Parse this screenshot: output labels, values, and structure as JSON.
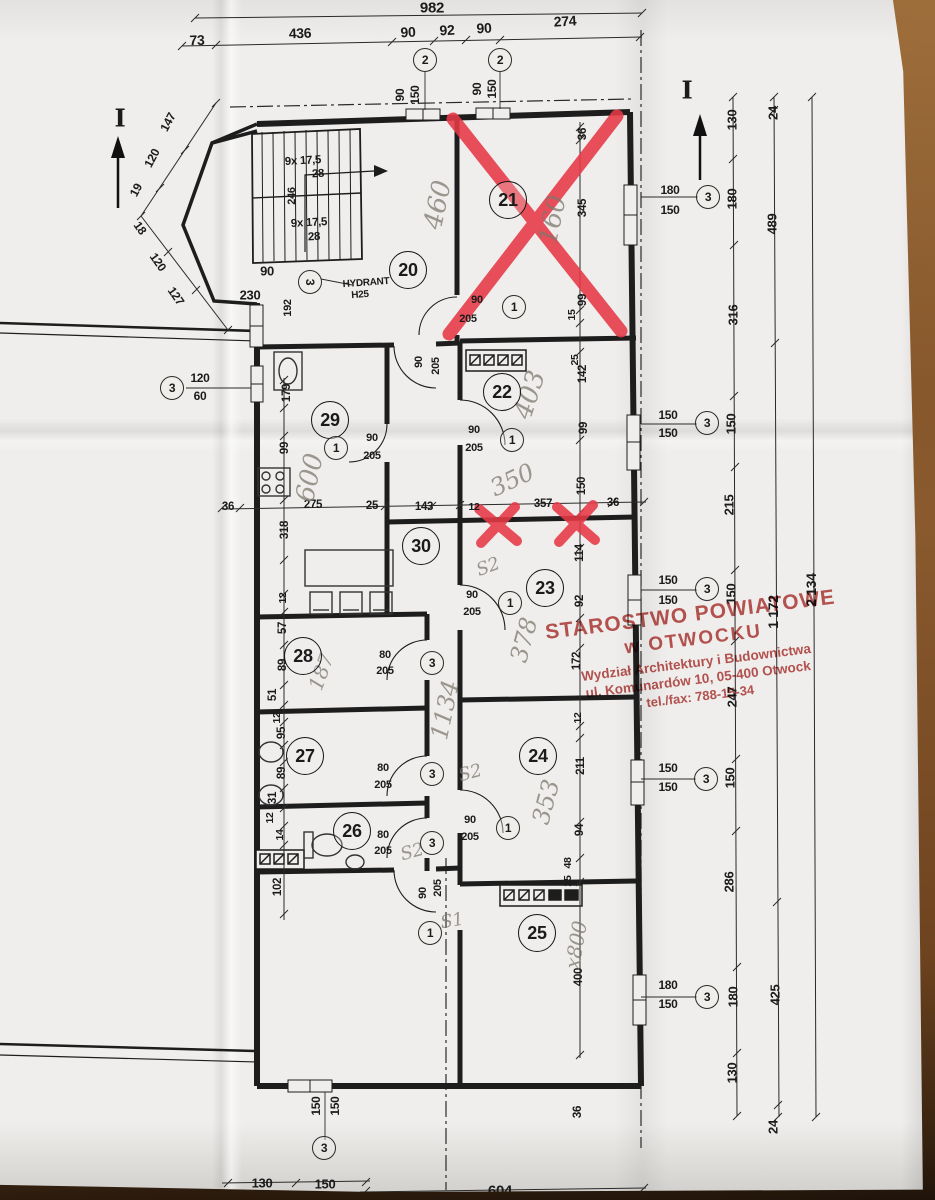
{
  "stamp": {
    "line1": "STAROSTWO POWIATOWE",
    "line2": "w OTWOCKU",
    "line3": "Wydział Architektury i Budownictwa",
    "line4": "ul. Komunardów 10, 05-400 Otwock",
    "line5": "tel./fax: 788-15-34"
  },
  "rooms": [
    [
      "20",
      408,
      270
    ],
    [
      "21",
      508,
      200
    ],
    [
      "22",
      502,
      392
    ],
    [
      "23",
      545,
      588
    ],
    [
      "24",
      538,
      756
    ],
    [
      "25",
      537,
      933
    ],
    [
      "26",
      352,
      831
    ],
    [
      "27",
      305,
      756
    ],
    [
      "28",
      303,
      656
    ],
    [
      "29",
      330,
      420
    ],
    [
      "30",
      421,
      546
    ]
  ],
  "bubbles": [
    [
      "2",
      425,
      60
    ],
    [
      "2",
      500,
      60
    ],
    [
      "3",
      708,
      197
    ],
    [
      "3",
      707,
      423
    ],
    [
      "3",
      707,
      589
    ],
    [
      "3",
      706,
      779
    ],
    [
      "3",
      707,
      997
    ],
    [
      "3",
      172,
      388
    ],
    [
      "3",
      324,
      1148
    ],
    [
      "1",
      514,
      307
    ],
    [
      "1",
      512,
      440
    ],
    [
      "1",
      336,
      448
    ],
    [
      "1",
      510,
      603
    ],
    [
      "1",
      508,
      828
    ],
    [
      "1",
      430,
      933
    ],
    [
      "3",
      432,
      663
    ],
    [
      "3",
      432,
      774
    ],
    [
      "3",
      432,
      843
    ],
    [
      "3",
      310,
      282,
      90
    ]
  ],
  "sections": [
    [
      "I",
      120,
      118
    ],
    [
      "I",
      687,
      90
    ]
  ],
  "dims": [
    [
      "982",
      432,
      8,
      0,
      15
    ],
    [
      "73",
      197,
      40,
      -2,
      14
    ],
    [
      "436",
      300,
      33,
      -2,
      14
    ],
    [
      "90",
      408,
      32,
      -3,
      14
    ],
    [
      "92",
      447,
      30,
      -3,
      14
    ],
    [
      "90",
      484,
      28,
      -3,
      14
    ],
    [
      "274",
      565,
      21,
      -3,
      14
    ],
    [
      "90",
      400,
      95,
      -90,
      12
    ],
    [
      "150",
      415,
      95,
      -90,
      12
    ],
    [
      "90",
      477,
      89,
      -90,
      12
    ],
    [
      "150",
      492,
      89,
      -90,
      12
    ],
    [
      "147",
      168,
      122,
      -62,
      12
    ],
    [
      "120",
      152,
      158,
      -62,
      12
    ],
    [
      "19",
      136,
      190,
      -62,
      12
    ],
    [
      "18",
      140,
      228,
      55,
      12
    ],
    [
      "120",
      158,
      262,
      55,
      12
    ],
    [
      "127",
      176,
      296,
      55,
      12
    ],
    [
      "9x 17,5",
      303,
      161,
      -3,
      11.5
    ],
    [
      "28",
      318,
      174,
      -3,
      11.5
    ],
    [
      "246",
      292,
      196,
      -90,
      11
    ],
    [
      "9x 17,5",
      309,
      223,
      -3,
      11.5
    ],
    [
      "28",
      314,
      237,
      -3,
      11.5
    ],
    [
      "90",
      267,
      271,
      0,
      13
    ],
    [
      "230",
      250,
      295,
      0,
      13
    ],
    [
      "192",
      288,
      308,
      -90,
      11
    ],
    [
      "90",
      477,
      300,
      0,
      11
    ],
    [
      "205",
      468,
      319,
      0,
      11
    ],
    [
      "90",
      419,
      362,
      -90,
      11
    ],
    [
      "205",
      436,
      366,
      -90,
      11
    ],
    [
      "36",
      583,
      134,
      -90,
      11.5
    ],
    [
      "345",
      583,
      208,
      -90,
      11.5
    ],
    [
      "99",
      583,
      300,
      -90,
      11.5
    ],
    [
      "15",
      572,
      315,
      -90,
      10.5
    ],
    [
      "25",
      575,
      360,
      -90,
      10.5
    ],
    [
      "142",
      583,
      374,
      -90,
      11.5
    ],
    [
      "99",
      584,
      428,
      -90,
      11.5
    ],
    [
      "150",
      582,
      486,
      -90,
      11.5
    ],
    [
      "114",
      580,
      553,
      -90,
      11.5
    ],
    [
      "92",
      580,
      601,
      -90,
      11.5
    ],
    [
      "172",
      577,
      661,
      -90,
      11.5
    ],
    [
      "12",
      578,
      718,
      -90,
      10.5
    ],
    [
      "211",
      581,
      766,
      -90,
      11.5
    ],
    [
      "94",
      580,
      830,
      -90,
      11.5
    ],
    [
      "48",
      568,
      863,
      -90,
      10.5
    ],
    [
      "25",
      568,
      881,
      -90,
      10.5
    ],
    [
      "400",
      579,
      977,
      -90,
      11.5
    ],
    [
      "36",
      578,
      1112,
      -90,
      11.5
    ],
    [
      "36",
      228,
      507,
      0,
      11.5
    ],
    [
      "275",
      313,
      505,
      0,
      11.5
    ],
    [
      "25",
      372,
      506,
      0,
      11.5
    ],
    [
      "143",
      424,
      507,
      0,
      11.5
    ],
    [
      "12",
      474,
      507,
      0,
      10.5
    ],
    [
      "357",
      543,
      504,
      0,
      11.5
    ],
    [
      "36",
      613,
      503,
      0,
      11.5
    ],
    [
      "179",
      287,
      393,
      -90,
      11.5
    ],
    [
      "99",
      285,
      448,
      -90,
      11.5
    ],
    [
      "318",
      285,
      530,
      -90,
      11.5
    ],
    [
      "12",
      283,
      598,
      -90,
      10.5
    ],
    [
      "57",
      283,
      628,
      -90,
      11.5
    ],
    [
      "89",
      283,
      665,
      -90,
      11.5
    ],
    [
      "51",
      273,
      695,
      -90,
      11.5
    ],
    [
      "12",
      277,
      718,
      -90,
      10.5
    ],
    [
      "95",
      282,
      733,
      -90,
      11.5
    ],
    [
      "89",
      282,
      773,
      -90,
      11.5
    ],
    [
      "31",
      273,
      798,
      -90,
      11.5
    ],
    [
      "12",
      270,
      818,
      -90,
      10.5
    ],
    [
      "14",
      280,
      835,
      -90,
      10.5
    ],
    [
      "102",
      278,
      887,
      -90,
      11.5
    ],
    [
      "120",
      200,
      378,
      0,
      12
    ],
    [
      "60",
      200,
      396,
      0,
      12
    ],
    [
      "90",
      474,
      430,
      0,
      11
    ],
    [
      "205",
      474,
      448,
      0,
      11
    ],
    [
      "90",
      372,
      438,
      0,
      11
    ],
    [
      "205",
      372,
      456,
      0,
      11
    ],
    [
      "90",
      472,
      595,
      0,
      11
    ],
    [
      "205",
      472,
      612,
      0,
      11
    ],
    [
      "80",
      385,
      655,
      0,
      11
    ],
    [
      "205",
      385,
      671,
      0,
      11
    ],
    [
      "80",
      383,
      768,
      0,
      11
    ],
    [
      "205",
      383,
      785,
      0,
      11
    ],
    [
      "80",
      383,
      835,
      0,
      11
    ],
    [
      "205",
      383,
      851,
      0,
      11
    ],
    [
      "90",
      470,
      820,
      0,
      11
    ],
    [
      "205",
      470,
      837,
      0,
      11
    ],
    [
      "90",
      423,
      893,
      -90,
      11
    ],
    [
      "205",
      438,
      888,
      -90,
      11
    ],
    [
      "180",
      670,
      190,
      0,
      12
    ],
    [
      "150",
      670,
      210,
      0,
      12
    ],
    [
      "150",
      668,
      415,
      0,
      12
    ],
    [
      "150",
      668,
      433,
      0,
      12
    ],
    [
      "150",
      668,
      580,
      0,
      12
    ],
    [
      "150",
      668,
      600,
      0,
      12
    ],
    [
      "150",
      668,
      768,
      0,
      12
    ],
    [
      "150",
      668,
      787,
      0,
      12
    ],
    [
      "180",
      668,
      985,
      0,
      12
    ],
    [
      "150",
      668,
      1004,
      0,
      12
    ],
    [
      "150",
      316,
      1106,
      -90,
      12
    ],
    [
      "150",
      335,
      1106,
      -90,
      12
    ],
    [
      "130",
      732,
      120,
      -90,
      13
    ],
    [
      "180",
      732,
      199,
      -90,
      13
    ],
    [
      "316",
      733,
      315,
      -90,
      13
    ],
    [
      "150",
      731,
      424,
      -90,
      13
    ],
    [
      "215",
      729,
      505,
      -90,
      13
    ],
    [
      "150",
      731,
      594,
      -90,
      13
    ],
    [
      "247",
      732,
      697,
      -90,
      13
    ],
    [
      "150",
      730,
      778,
      -90,
      13
    ],
    [
      "286",
      729,
      882,
      -90,
      13
    ],
    [
      "180",
      733,
      997,
      -90,
      13
    ],
    [
      "130",
      732,
      1073,
      -90,
      13
    ],
    [
      "24",
      773,
      113,
      -90,
      13
    ],
    [
      "489",
      772,
      224,
      -90,
      13
    ],
    [
      "1 172",
      773,
      612,
      -90,
      14
    ],
    [
      "425",
      775,
      995,
      -90,
      13
    ],
    [
      "24",
      773,
      1127,
      -90,
      13
    ],
    [
      "2 134",
      811,
      590,
      -90,
      14
    ],
    [
      "130",
      262,
      1183,
      0,
      13
    ],
    [
      "150",
      325,
      1184,
      0,
      13
    ],
    [
      "604",
      500,
      1191,
      0,
      15
    ]
  ],
  "hand": [
    [
      "HYDRANT",
      366,
      283,
      -4,
      10
    ],
    [
      "H25",
      360,
      295,
      -4,
      10
    ]
  ],
  "pencil": [
    [
      "460",
      438,
      205,
      -78,
      26
    ],
    [
      "160",
      553,
      220,
      -78,
      26
    ],
    [
      "403",
      530,
      395,
      -72,
      26
    ],
    [
      "350",
      512,
      480,
      -25,
      24
    ],
    [
      "600",
      310,
      478,
      -78,
      26
    ],
    [
      "378",
      524,
      640,
      -75,
      24
    ],
    [
      "1134",
      445,
      710,
      -78,
      24
    ],
    [
      "187",
      321,
      672,
      -70,
      20
    ],
    [
      "S2",
      488,
      567,
      -20,
      18
    ],
    [
      "S2",
      470,
      773,
      -15,
      18
    ],
    [
      "S2",
      412,
      852,
      -15,
      18
    ],
    [
      "353",
      546,
      802,
      -75,
      24
    ],
    [
      "S1",
      452,
      921,
      -10,
      18
    ],
    [
      "x800",
      576,
      945,
      -80,
      20
    ]
  ]
}
